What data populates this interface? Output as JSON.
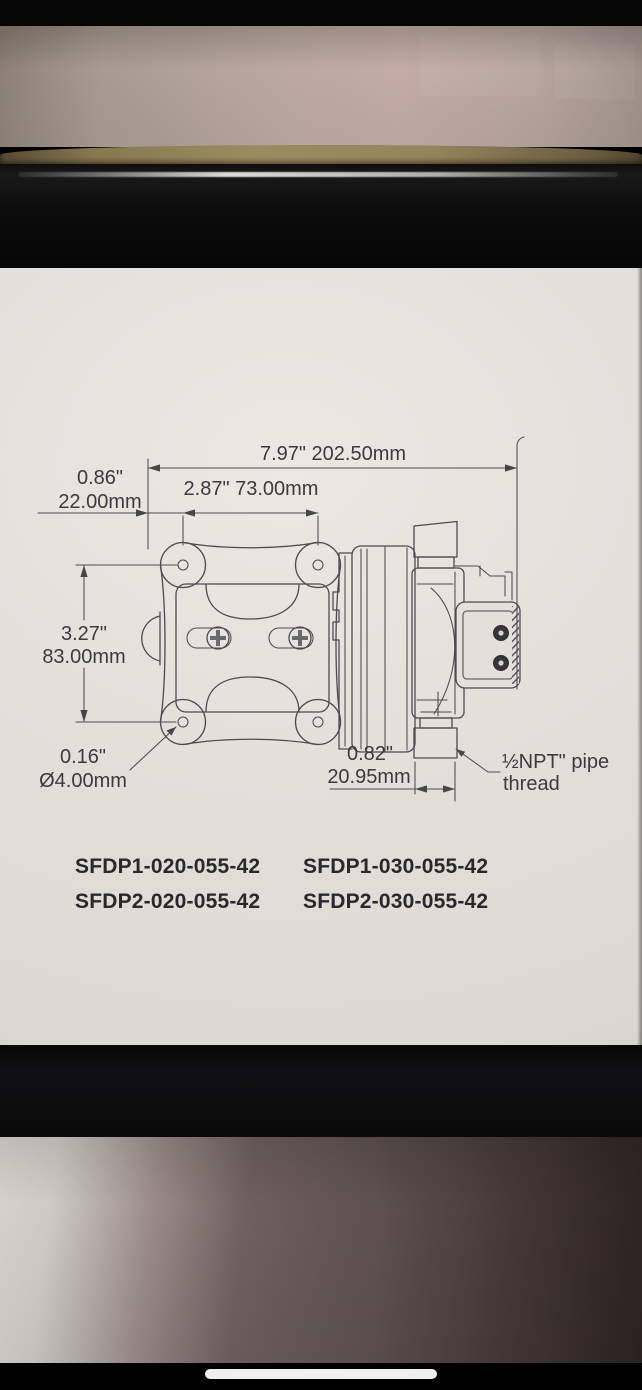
{
  "label": {
    "dim_overall": "7.97\"  202.50mm",
    "dim_offset_in": "0.86\"",
    "dim_offset_mm": "22.00mm",
    "dim_hole_spacing": "2.87\"  73.00mm",
    "dim_height_in": "3.27\"",
    "dim_height_mm": "83.00mm",
    "dim_hole_in": "0.16\"",
    "dim_hole_mm": "Ø4.00mm",
    "dim_port_in": "0.82\"",
    "dim_port_mm": "20.95mm",
    "note_thread_line1": "½NPT\" pipe",
    "note_thread_line2": "thread",
    "models": [
      "SFDP1-020-055-42",
      "SFDP1-030-055-42",
      "SFDP2-020-055-42",
      "SFDP2-030-055-42"
    ]
  },
  "colors": {
    "label_background": "#e3e0da",
    "drawing_line": "#4b4b52",
    "dimension_text": "#3a3a41",
    "model_text": "#28282f",
    "box_black": "#0b0b0c",
    "wall": "#b5a49d",
    "cardboard_edge": "#8a7b54",
    "table_surface_dark": "#4a3e3d",
    "home_indicator": "#fbfbfb"
  }
}
